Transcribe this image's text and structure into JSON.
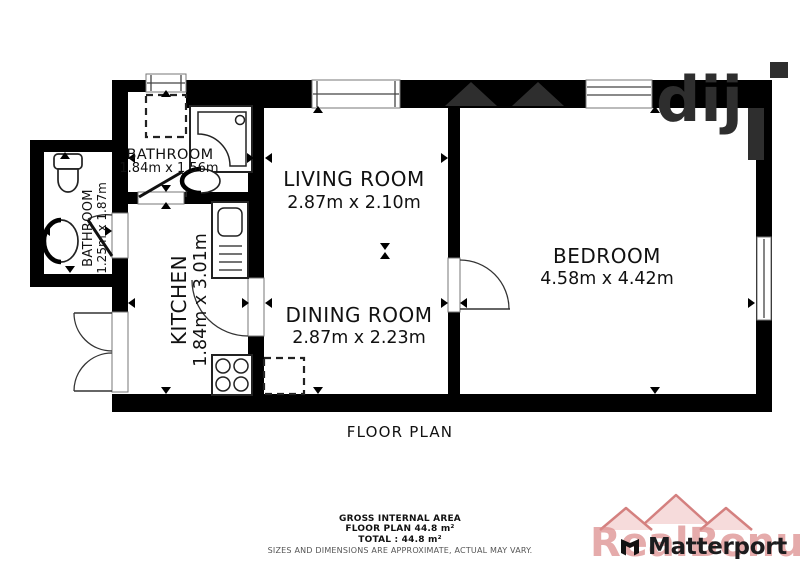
{
  "title": "FLOOR PLAN",
  "rooms": {
    "bathroom_top": {
      "name": "BATHROOM",
      "dims": "1.84m x 1.56m"
    },
    "bathroom_left": {
      "name": "BATHROOM",
      "dims": "1.25m x 1.87m"
    },
    "kitchen": {
      "name": "KITCHEN",
      "dims": "1.84m x 3.01m"
    },
    "living": {
      "name": "LIVING ROOM",
      "dims": "2.87m x 2.10m"
    },
    "dining": {
      "name": "DINING ROOM",
      "dims": "2.87m x 2.23m"
    },
    "bedroom": {
      "name": "BEDROOM",
      "dims": "4.58m x 4.42m"
    }
  },
  "footer": {
    "area_label": "GROSS INTERNAL AREA",
    "floor_plan_area": "FLOOR PLAN 44.8 m²",
    "total": "TOTAL :  44.8 m²",
    "disclaimer": "SIZES AND DIMENSIONS ARE APPROXIMATE, ACTUAL MAY VARY."
  },
  "branding": {
    "logo": "Matterport",
    "watermark": "RealBonus",
    "top_watermark_fragment": "dij"
  },
  "colors": {
    "wall": "#000000",
    "fixture_line": "#222222",
    "top_watermark": "#2e2e2e",
    "brand_watermark": "#e3a9a9",
    "logo_text": "#1c1c1e"
  }
}
